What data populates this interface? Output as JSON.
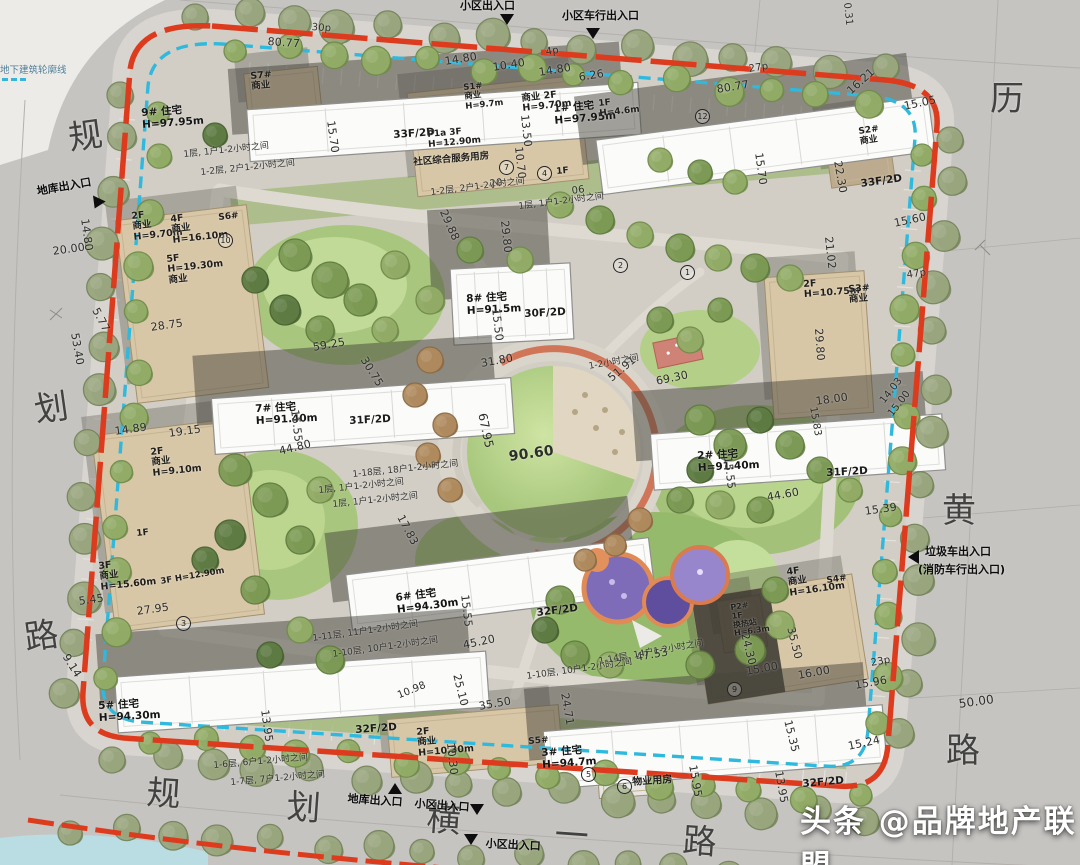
{
  "watermark": "头条 @品牌地产联盟",
  "legend": "地下建筑轮廓线",
  "colors": {
    "boundary_red": "#dd3b1e",
    "underground_blue": "#2fb9dd",
    "track_orange": "#cf6a4b",
    "lawn_green": "#aecb81",
    "building_white": "#fbfbf9",
    "commercial_tan": "#d8c7a7",
    "playground_purple": "#7e6cb8"
  },
  "roads": {
    "left": [
      "规",
      "划",
      "路"
    ],
    "right": [
      "历",
      "黄",
      "路"
    ],
    "bottom": [
      "规",
      "划",
      "横",
      "一",
      "路"
    ]
  },
  "entrances": [
    "小区出入口",
    "小区车行出入口",
    "地库出入口",
    "垃圾车出入口",
    "(消防车行出入口)",
    "地库出入口",
    "小区出入口",
    "小区出入口"
  ],
  "buildings": [
    "9# 住宅\nH=97.95m",
    "1# 住宅\nH=97.95m",
    "8# 住宅\nH=91.5m",
    "7# 住宅\nH=91.40m",
    "2# 住宅\nH=91.40m",
    "6# 住宅\nH=94.30m",
    "5# 住宅\nH=94.30m",
    "3# 住宅\nH=94.7m"
  ],
  "floors": [
    "33F/2D",
    "33F/2D",
    "30F/2D",
    "31F/2D",
    "31F/2D",
    "32F/2D",
    "32F/2D",
    "32F/2D"
  ],
  "commercial": [
    "S7#\n商业",
    "S1#\n商业\nH=9.7m",
    "商业 2F\nH=9.70m",
    "1F\nH=4.6m",
    "P1a 3F\nH=12.90m",
    "社区综合服务用房",
    "1F",
    "2F\n商业\nH=9.70m",
    "4F\n商业\nH=16.10m",
    "S6#",
    "5F\nH=19.30m\n商业",
    "2F\n商业\nH=9.10m",
    "1F",
    "3F\n商业\nH=15.60m",
    "3F H=12.90m",
    "S2#\n商业",
    "2F\nH=10.75m",
    "S3#\n商业",
    "4F\n商业\nH=16.10m",
    "S4#",
    "P2#\n1F\n换热站\nH=6.3m",
    "2F\n商业\nH=10.30m",
    "S5#",
    "物业用房"
  ],
  "badges": [
    "1",
    "2",
    "3",
    "4",
    "5",
    "6",
    "7",
    "9",
    "10",
    "12"
  ],
  "dims": [
    "80.77",
    "30p",
    "14.80",
    "10.40",
    "14.80",
    "6.26",
    "4p",
    "27p",
    "80.77",
    "0.31",
    "16.21",
    "15.05",
    "22.30",
    "15.70",
    "15.70",
    "15.60",
    "21.02",
    "47p",
    "29.80",
    "18.00",
    "14.03",
    "15.00",
    "15.83",
    "15.39",
    "20.00",
    "14.80",
    "5.77",
    "53.40",
    "28.75",
    "14.89",
    "19.15",
    "13.50",
    "10.70",
    "20",
    "06",
    "29.88",
    "29.80",
    "59.25",
    "30.75",
    "31.80",
    "51.91",
    "69.30",
    "90.60",
    "67.95",
    "17.83",
    "15.55",
    "44.80",
    "15.55",
    "44.60",
    "15.50",
    "15.55",
    "45.20",
    "25.10",
    "35.50",
    "10.98",
    "24.71",
    "47.53",
    "24.30",
    "35.50",
    "15.00",
    "16.00",
    "23p",
    "15.96",
    "50.00",
    "15.35",
    "15.24",
    "15.95",
    "13.95",
    "13.95",
    "5.45",
    "27.95",
    "9.14",
    "10.30"
  ],
  "notes": [
    "1层, 1户1-2小时之间",
    "1-2层, 2户1-2小时之间",
    "1-2层, 2户1-2小时之间",
    "1层, 1户1-2小时之间",
    "1-2小时之间",
    "1-18层, 18户1-2小时之间",
    "1层, 1户1-2小时之间",
    "1层, 1户1-2小时之间",
    "1-11层, 11户1-2小时之间",
    "1-10层, 10户1-2小时之间",
    "1-14层, 14户1-2小时之间",
    "1-10层, 10户1-2小时之间",
    "1-6层, 6户1-2小时之间",
    "1-7层, 7户1-2小时之间"
  ]
}
